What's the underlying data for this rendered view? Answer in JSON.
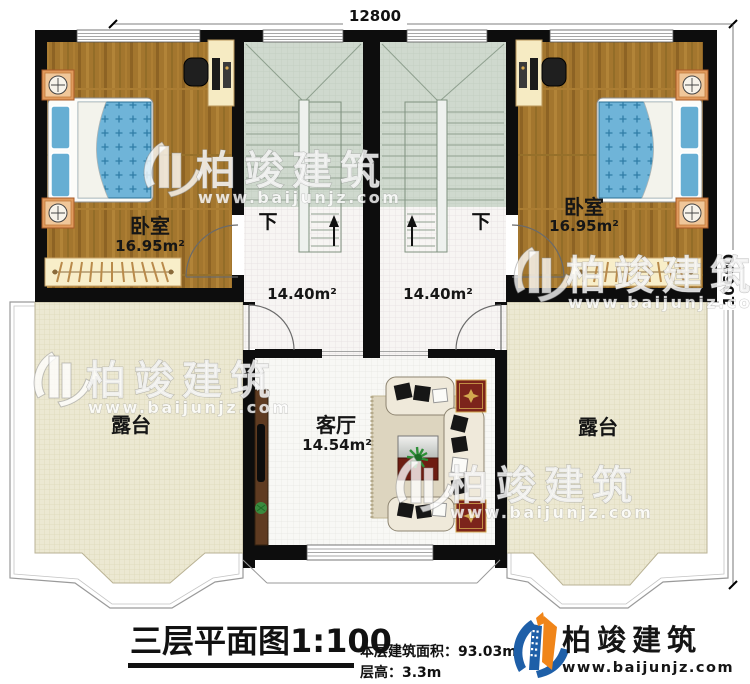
{
  "dimensions": {
    "top": "12800",
    "right": "10600"
  },
  "rooms": {
    "bedroom_left": {
      "name": "卧室",
      "area": "16.95m²"
    },
    "bedroom_right": {
      "name": "卧室",
      "area": "16.95m²"
    },
    "stairhall_left": {
      "area": "14.40m²",
      "down_label": "下"
    },
    "stairhall_right": {
      "area": "14.40m²",
      "down_label": "下"
    },
    "living_room": {
      "name": "客厅",
      "area": "14.54m²"
    },
    "terrace_left": {
      "name": "露台"
    },
    "terrace_right": {
      "name": "露台"
    }
  },
  "title_block": {
    "title": "三层平面图1:100",
    "floor_area": "本层建筑面积：93.03m²",
    "floor_height": "层高：3.3m"
  },
  "brand": {
    "name": "柏竣建筑",
    "website": "www.baijunjz.com"
  },
  "watermark": {
    "name": "柏竣建筑",
    "website": "www.baijunjz.com"
  },
  "colors": {
    "wall": "#0d0d0d",
    "wood": "#a3762e",
    "bed_blue": "#6fb4d8",
    "stair_green": "#cfd9ce",
    "terrace": "#ebe7d0",
    "brand_blue": "#1e5fa8",
    "brand_orange": "#f08519"
  }
}
